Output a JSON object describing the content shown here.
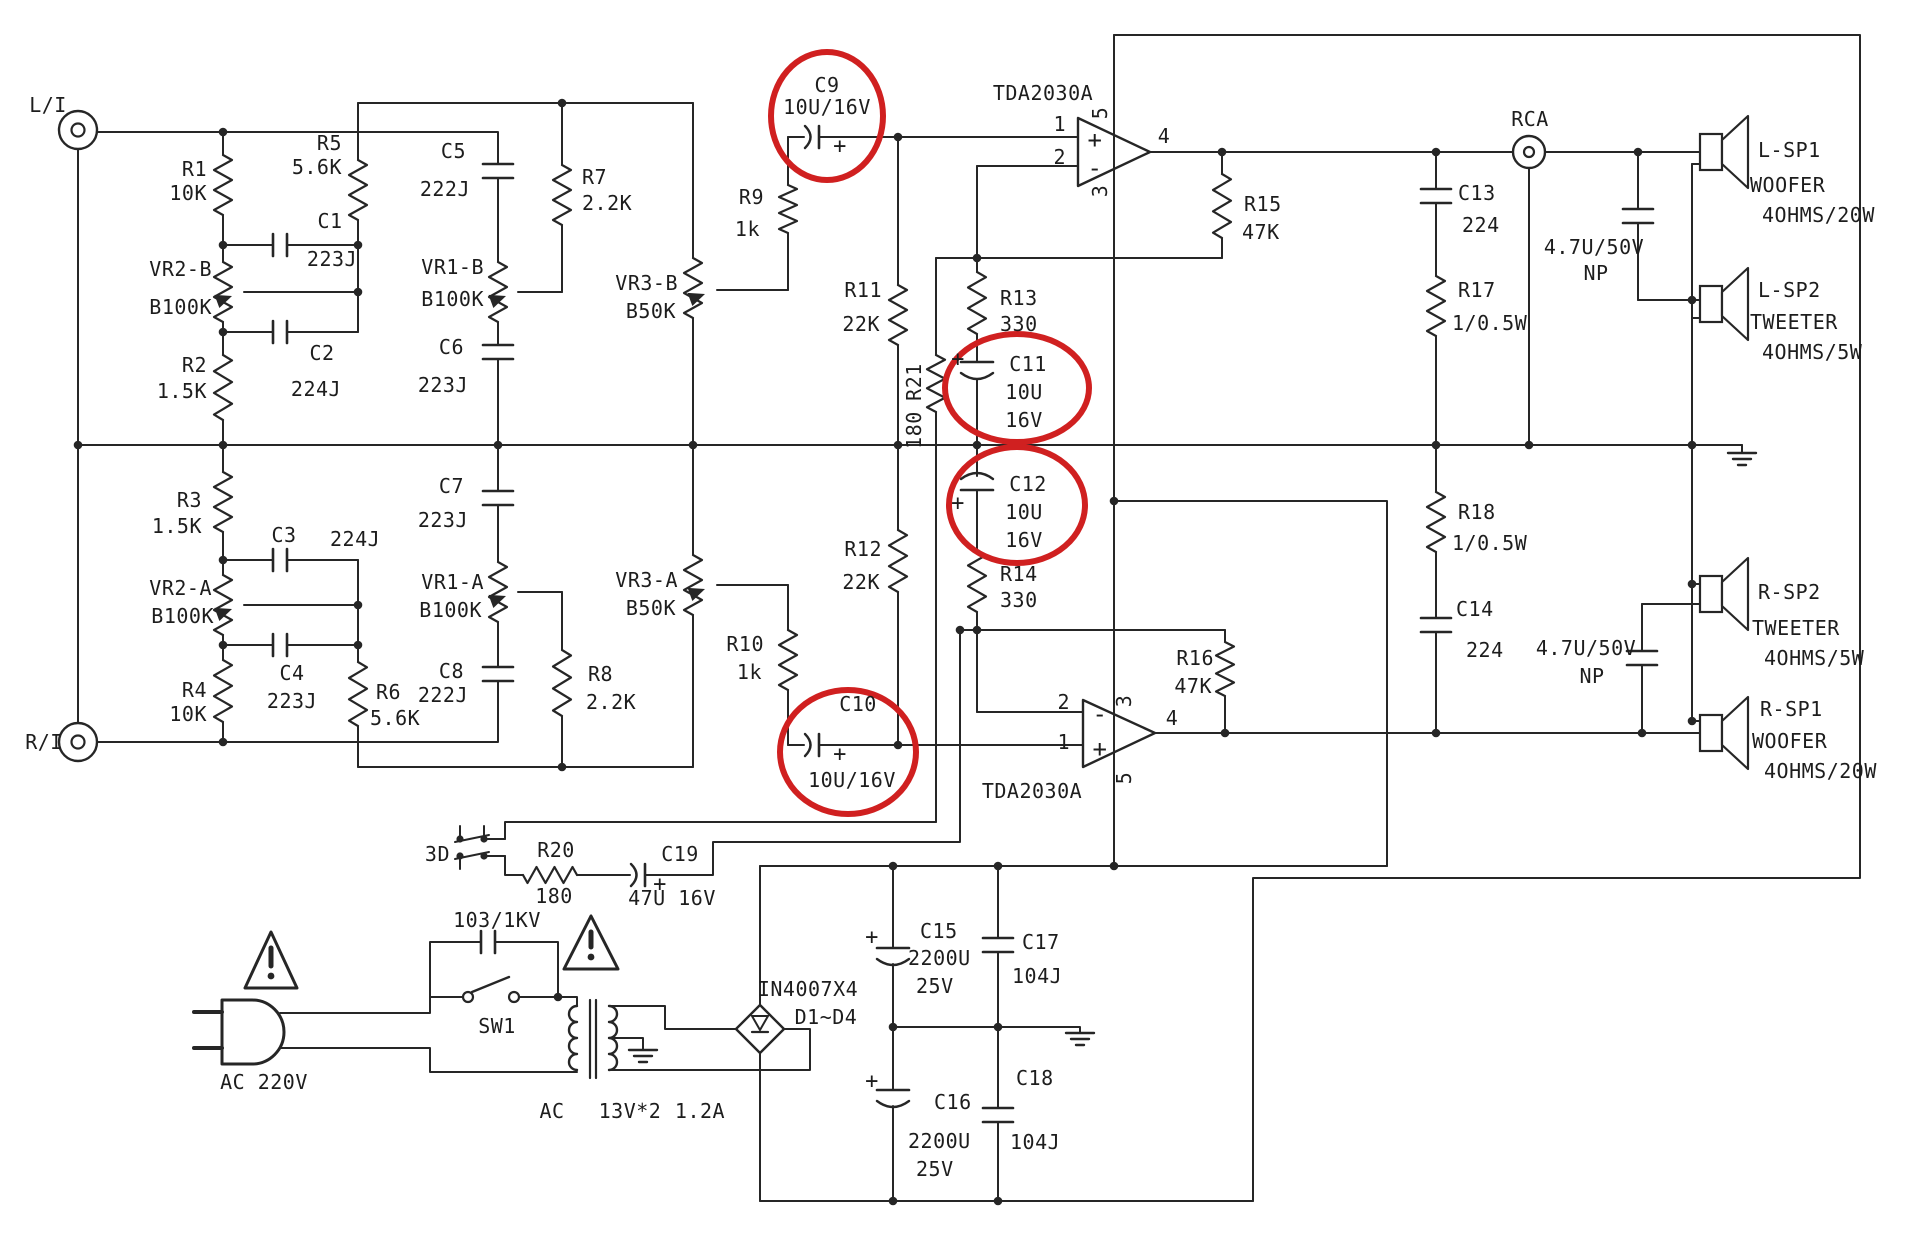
{
  "meta": {
    "description": "Scanned schematic of a TDA2030A stereo tone-control amplifier with power supply",
    "ink_color": "#262626",
    "highlight_color": "#d02020",
    "highlighted_parts": [
      "C9",
      "C10",
      "C11",
      "C12"
    ]
  },
  "labels": [
    {
      "id": "li",
      "t": "L/I",
      "x": 48,
      "y": 112,
      "a": "m"
    },
    {
      "id": "ri",
      "t": "R/I",
      "x": 44,
      "y": 749,
      "a": "m"
    },
    {
      "id": "r1",
      "t": "R1",
      "x": 207,
      "y": 176,
      "a": "e"
    },
    {
      "id": "r1v",
      "t": "10K",
      "x": 207,
      "y": 200,
      "a": "e"
    },
    {
      "id": "r5",
      "t": "R5",
      "x": 342,
      "y": 150,
      "a": "e"
    },
    {
      "id": "r5v",
      "t": "5.6K",
      "x": 342,
      "y": 174,
      "a": "e"
    },
    {
      "id": "c1",
      "t": "C1",
      "x": 330,
      "y": 228,
      "a": "m"
    },
    {
      "id": "c1v",
      "t": "223J",
      "x": 332,
      "y": 266,
      "a": "m"
    },
    {
      "id": "vr2b",
      "t": "VR2-B",
      "x": 212,
      "y": 276,
      "a": "e"
    },
    {
      "id": "vr2bv",
      "t": "B100K",
      "x": 212,
      "y": 314,
      "a": "e"
    },
    {
      "id": "c2",
      "t": "C2",
      "x": 322,
      "y": 360,
      "a": "m"
    },
    {
      "id": "c2v",
      "t": "224J",
      "x": 316,
      "y": 396,
      "a": "m"
    },
    {
      "id": "r2",
      "t": "R2",
      "x": 207,
      "y": 372,
      "a": "e"
    },
    {
      "id": "r2v",
      "t": "1.5K",
      "x": 207,
      "y": 398,
      "a": "e"
    },
    {
      "id": "c5",
      "t": "C5",
      "x": 466,
      "y": 158,
      "a": "e"
    },
    {
      "id": "c5v",
      "t": "222J",
      "x": 470,
      "y": 196,
      "a": "e"
    },
    {
      "id": "vr1b",
      "t": "VR1-B",
      "x": 484,
      "y": 274,
      "a": "e"
    },
    {
      "id": "vr1bv",
      "t": "B100K",
      "x": 484,
      "y": 306,
      "a": "e"
    },
    {
      "id": "c6",
      "t": "C6",
      "x": 464,
      "y": 354,
      "a": "e"
    },
    {
      "id": "c6v",
      "t": "223J",
      "x": 468,
      "y": 392,
      "a": "e"
    },
    {
      "id": "r7",
      "t": "R7",
      "x": 582,
      "y": 184,
      "a": "s"
    },
    {
      "id": "r7v",
      "t": "2.2K",
      "x": 582,
      "y": 210,
      "a": "s"
    },
    {
      "id": "vr3b",
      "t": "VR3-B",
      "x": 678,
      "y": 290,
      "a": "e"
    },
    {
      "id": "vr3bv",
      "t": "B50K",
      "x": 676,
      "y": 318,
      "a": "e"
    },
    {
      "id": "r9",
      "t": "R9",
      "x": 764,
      "y": 204,
      "a": "e"
    },
    {
      "id": "r9v",
      "t": "1k",
      "x": 760,
      "y": 236,
      "a": "e"
    },
    {
      "id": "c9",
      "t": "C9",
      "x": 827,
      "y": 92,
      "a": "m"
    },
    {
      "id": "c9v",
      "t": "10U/16V",
      "x": 827,
      "y": 114,
      "a": "m"
    },
    {
      "id": "c9p",
      "t": "+",
      "x": 840,
      "y": 153,
      "a": "m",
      "s": 22
    },
    {
      "id": "u1",
      "t": "TDA2030A",
      "x": 1043,
      "y": 100,
      "a": "m"
    },
    {
      "id": "u1p1",
      "t": "1",
      "x": 1066,
      "y": 131,
      "a": "e"
    },
    {
      "id": "u1p2",
      "t": "2",
      "x": 1066,
      "y": 164,
      "a": "e"
    },
    {
      "id": "u1plus",
      "t": "+",
      "x": 1095,
      "y": 148,
      "a": "m",
      "s": 24
    },
    {
      "id": "u1minus",
      "t": "-",
      "x": 1095,
      "y": 176,
      "a": "m",
      "s": 24
    },
    {
      "id": "u1p5",
      "t": "5",
      "x": 1107,
      "y": 113,
      "a": "m",
      "r": -90
    },
    {
      "id": "u1p3",
      "t": "3",
      "x": 1107,
      "y": 191,
      "a": "m",
      "r": -90
    },
    {
      "id": "u1p4",
      "t": "4",
      "x": 1164,
      "y": 143,
      "a": "m"
    },
    {
      "id": "r11",
      "t": "R11",
      "x": 882,
      "y": 297,
      "a": "e"
    },
    {
      "id": "r11v",
      "t": "22K",
      "x": 880,
      "y": 331,
      "a": "e"
    },
    {
      "id": "r21",
      "t": "R21",
      "x": 921,
      "y": 382,
      "a": "m",
      "r": -90
    },
    {
      "id": "r21v",
      "t": "180",
      "x": 921,
      "y": 430,
      "a": "m",
      "r": -90
    },
    {
      "id": "r13",
      "t": "R13",
      "x": 1000,
      "y": 305,
      "a": "s"
    },
    {
      "id": "r13v",
      "t": "330",
      "x": 1000,
      "y": 331,
      "a": "s"
    },
    {
      "id": "c11",
      "t": "C11",
      "x": 1028,
      "y": 371,
      "a": "m"
    },
    {
      "id": "c11v",
      "t": "10U",
      "x": 1024,
      "y": 399,
      "a": "m"
    },
    {
      "id": "c11v2",
      "t": "16V",
      "x": 1024,
      "y": 427,
      "a": "m"
    },
    {
      "id": "c11p",
      "t": "+",
      "x": 958,
      "y": 366,
      "a": "m",
      "s": 22
    },
    {
      "id": "c12",
      "t": "C12",
      "x": 1028,
      "y": 491,
      "a": "m"
    },
    {
      "id": "c12v",
      "t": "10U",
      "x": 1024,
      "y": 519,
      "a": "m"
    },
    {
      "id": "c12v2",
      "t": "16V",
      "x": 1024,
      "y": 547,
      "a": "m"
    },
    {
      "id": "c12p",
      "t": "+",
      "x": 958,
      "y": 510,
      "a": "m",
      "s": 22
    },
    {
      "id": "r14",
      "t": "R14",
      "x": 1000,
      "y": 581,
      "a": "s"
    },
    {
      "id": "r14v",
      "t": "330",
      "x": 1000,
      "y": 607,
      "a": "s"
    },
    {
      "id": "r12",
      "t": "R12",
      "x": 882,
      "y": 556,
      "a": "e"
    },
    {
      "id": "r12v",
      "t": "22K",
      "x": 880,
      "y": 589,
      "a": "e"
    },
    {
      "id": "r15",
      "t": "R15",
      "x": 1244,
      "y": 211,
      "a": "s"
    },
    {
      "id": "r15v",
      "t": "47K",
      "x": 1242,
      "y": 239,
      "a": "s"
    },
    {
      "id": "rca",
      "t": "RCA",
      "x": 1530,
      "y": 126,
      "a": "m"
    },
    {
      "id": "c13",
      "t": "C13",
      "x": 1458,
      "y": 200,
      "a": "s"
    },
    {
      "id": "c13v",
      "t": "224",
      "x": 1462,
      "y": 232,
      "a": "s"
    },
    {
      "id": "r17",
      "t": "R17",
      "x": 1458,
      "y": 297,
      "a": "s"
    },
    {
      "id": "r17v",
      "t": "1/0.5W",
      "x": 1452,
      "y": 330,
      "a": "s"
    },
    {
      "id": "np1",
      "t": "4.7U/50V",
      "x": 1594,
      "y": 254,
      "a": "m"
    },
    {
      "id": "np1v",
      "t": "NP",
      "x": 1596,
      "y": 280,
      "a": "m"
    },
    {
      "id": "lsp1",
      "t": "L-SP1",
      "x": 1758,
      "y": 157,
      "a": "s"
    },
    {
      "id": "lsp1t",
      "t": "WOOFER",
      "x": 1750,
      "y": 192,
      "a": "s"
    },
    {
      "id": "lsp1v",
      "t": "4OHMS/20W",
      "x": 1762,
      "y": 222,
      "a": "s"
    },
    {
      "id": "lsp2",
      "t": "L-SP2",
      "x": 1758,
      "y": 297,
      "a": "s"
    },
    {
      "id": "lsp2t",
      "t": "TWEETER",
      "x": 1750,
      "y": 329,
      "a": "s"
    },
    {
      "id": "lsp2v",
      "t": "4OHMS/5W",
      "x": 1762,
      "y": 359,
      "a": "s"
    },
    {
      "id": "r18",
      "t": "R18",
      "x": 1458,
      "y": 519,
      "a": "s"
    },
    {
      "id": "r18v",
      "t": "1/0.5W",
      "x": 1452,
      "y": 550,
      "a": "s"
    },
    {
      "id": "c14",
      "t": "C14",
      "x": 1456,
      "y": 616,
      "a": "s"
    },
    {
      "id": "c14v",
      "t": "224",
      "x": 1466,
      "y": 657,
      "a": "s"
    },
    {
      "id": "np2",
      "t": "4.7U/50V",
      "x": 1586,
      "y": 655,
      "a": "m"
    },
    {
      "id": "np2v",
      "t": "NP",
      "x": 1592,
      "y": 683,
      "a": "m"
    },
    {
      "id": "rsp2",
      "t": "R-SP2",
      "x": 1758,
      "y": 599,
      "a": "s"
    },
    {
      "id": "rsp2t",
      "t": "TWEETER",
      "x": 1752,
      "y": 635,
      "a": "s"
    },
    {
      "id": "rsp2v",
      "t": "4OHMS/5W",
      "x": 1764,
      "y": 665,
      "a": "s"
    },
    {
      "id": "rsp1",
      "t": "R-SP1",
      "x": 1760,
      "y": 716,
      "a": "s"
    },
    {
      "id": "rsp1t",
      "t": "WOOFER",
      "x": 1752,
      "y": 748,
      "a": "s"
    },
    {
      "id": "rsp1v",
      "t": "4OHMS/20W",
      "x": 1764,
      "y": 778,
      "a": "s"
    },
    {
      "id": "r3",
      "t": "R3",
      "x": 202,
      "y": 507,
      "a": "e"
    },
    {
      "id": "r3v",
      "t": "1.5K",
      "x": 202,
      "y": 533,
      "a": "e"
    },
    {
      "id": "c3",
      "t": "C3",
      "x": 284,
      "y": 542,
      "a": "m"
    },
    {
      "id": "c3v",
      "t": "224J",
      "x": 330,
      "y": 546,
      "a": "s"
    },
    {
      "id": "vr2a",
      "t": "VR2-A",
      "x": 212,
      "y": 595,
      "a": "e"
    },
    {
      "id": "vr2av",
      "t": "B100K",
      "x": 214,
      "y": 623,
      "a": "e"
    },
    {
      "id": "c4",
      "t": "C4",
      "x": 292,
      "y": 680,
      "a": "m"
    },
    {
      "id": "c4v",
      "t": "223J",
      "x": 292,
      "y": 708,
      "a": "m"
    },
    {
      "id": "r4",
      "t": "R4",
      "x": 207,
      "y": 697,
      "a": "e"
    },
    {
      "id": "r4v",
      "t": "10K",
      "x": 207,
      "y": 721,
      "a": "e"
    },
    {
      "id": "r6",
      "t": "R6",
      "x": 376,
      "y": 699,
      "a": "s"
    },
    {
      "id": "r6v",
      "t": "5.6K",
      "x": 370,
      "y": 725,
      "a": "s"
    },
    {
      "id": "c7",
      "t": "C7",
      "x": 464,
      "y": 493,
      "a": "e"
    },
    {
      "id": "c7v",
      "t": "223J",
      "x": 468,
      "y": 527,
      "a": "e"
    },
    {
      "id": "vr1a",
      "t": "VR1-A",
      "x": 484,
      "y": 589,
      "a": "e"
    },
    {
      "id": "vr1av",
      "t": "B100K",
      "x": 482,
      "y": 617,
      "a": "e"
    },
    {
      "id": "c8",
      "t": "C8",
      "x": 464,
      "y": 678,
      "a": "e"
    },
    {
      "id": "c8v",
      "t": "222J",
      "x": 468,
      "y": 702,
      "a": "e"
    },
    {
      "id": "r8",
      "t": "R8",
      "x": 588,
      "y": 681,
      "a": "s"
    },
    {
      "id": "r8v",
      "t": "2.2K",
      "x": 586,
      "y": 709,
      "a": "s"
    },
    {
      "id": "vr3a",
      "t": "VR3-A",
      "x": 678,
      "y": 587,
      "a": "e"
    },
    {
      "id": "vr3av",
      "t": "B50K",
      "x": 676,
      "y": 615,
      "a": "e"
    },
    {
      "id": "r10",
      "t": "R10",
      "x": 764,
      "y": 651,
      "a": "e"
    },
    {
      "id": "r10v",
      "t": "1k",
      "x": 762,
      "y": 679,
      "a": "e"
    },
    {
      "id": "c10",
      "t": "C10",
      "x": 858,
      "y": 711,
      "a": "m"
    },
    {
      "id": "c10v",
      "t": "10U/16V",
      "x": 852,
      "y": 787,
      "a": "m"
    },
    {
      "id": "c10p",
      "t": "+",
      "x": 840,
      "y": 761,
      "a": "m",
      "s": 22
    },
    {
      "id": "u2",
      "t": "TDA2030A",
      "x": 1032,
      "y": 798,
      "a": "m"
    },
    {
      "id": "u2p2",
      "t": "2",
      "x": 1070,
      "y": 709,
      "a": "e"
    },
    {
      "id": "u2p1",
      "t": "1",
      "x": 1070,
      "y": 749,
      "a": "e"
    },
    {
      "id": "u2minus",
      "t": "-",
      "x": 1100,
      "y": 722,
      "a": "m",
      "s": 24
    },
    {
      "id": "u2plus",
      "t": "+",
      "x": 1100,
      "y": 757,
      "a": "m",
      "s": 24
    },
    {
      "id": "u2p3",
      "t": "3",
      "x": 1131,
      "y": 701,
      "a": "m",
      "r": -90
    },
    {
      "id": "u2p5",
      "t": "5",
      "x": 1131,
      "y": 778,
      "a": "m",
      "r": -90
    },
    {
      "id": "u2p4",
      "t": "4",
      "x": 1172,
      "y": 725,
      "a": "m"
    },
    {
      "id": "r16",
      "t": "R16",
      "x": 1214,
      "y": 665,
      "a": "e"
    },
    {
      "id": "r16v",
      "t": "47K",
      "x": 1212,
      "y": 693,
      "a": "e"
    },
    {
      "id": "sw3d",
      "t": "3D",
      "x": 450,
      "y": 861,
      "a": "e"
    },
    {
      "id": "r20",
      "t": "R20",
      "x": 556,
      "y": 857,
      "a": "m"
    },
    {
      "id": "r20v",
      "t": "180",
      "x": 554,
      "y": 903,
      "a": "m"
    },
    {
      "id": "c19",
      "t": "C19",
      "x": 680,
      "y": 861,
      "a": "m"
    },
    {
      "id": "c19v",
      "t": "47U 16V",
      "x": 672,
      "y": 905,
      "a": "m"
    },
    {
      "id": "c19p",
      "t": "+",
      "x": 660,
      "y": 891,
      "a": "m",
      "s": 22
    },
    {
      "id": "cx",
      "t": "103/1KV",
      "x": 497,
      "y": 927,
      "a": "m"
    },
    {
      "id": "sw1",
      "t": "SW1",
      "x": 497,
      "y": 1033,
      "a": "m"
    },
    {
      "id": "ac",
      "t": "AC 220V",
      "x": 264,
      "y": 1089,
      "a": "m"
    },
    {
      "id": "acs1",
      "t": "AC",
      "x": 552,
      "y": 1118,
      "a": "m"
    },
    {
      "id": "acs2",
      "t": "13V*2",
      "x": 630,
      "y": 1118,
      "a": "m"
    },
    {
      "id": "acs3",
      "t": "1.2A",
      "x": 700,
      "y": 1118,
      "a": "m"
    },
    {
      "id": "br",
      "t": "IN4007X4",
      "x": 808,
      "y": 996,
      "a": "m"
    },
    {
      "id": "brv",
      "t": "D1~D4",
      "x": 826,
      "y": 1024,
      "a": "m"
    },
    {
      "id": "c15",
      "t": "C15",
      "x": 920,
      "y": 938,
      "a": "s"
    },
    {
      "id": "c15v",
      "t": "2200U",
      "x": 908,
      "y": 965,
      "a": "s"
    },
    {
      "id": "c15v2",
      "t": "25V",
      "x": 916,
      "y": 993,
      "a": "s"
    },
    {
      "id": "c15p",
      "t": "+",
      "x": 872,
      "y": 944,
      "a": "m",
      "s": 22
    },
    {
      "id": "c17",
      "t": "C17",
      "x": 1022,
      "y": 949,
      "a": "s"
    },
    {
      "id": "c17v",
      "t": "104J",
      "x": 1012,
      "y": 983,
      "a": "s"
    },
    {
      "id": "c16",
      "t": "C16",
      "x": 934,
      "y": 1109,
      "a": "s"
    },
    {
      "id": "c16v",
      "t": "2200U",
      "x": 908,
      "y": 1148,
      "a": "s"
    },
    {
      "id": "c16v2",
      "t": "25V",
      "x": 916,
      "y": 1176,
      "a": "s"
    },
    {
      "id": "c16p",
      "t": "+",
      "x": 872,
      "y": 1088,
      "a": "m",
      "s": 22
    },
    {
      "id": "c18",
      "t": "C18",
      "x": 1016,
      "y": 1085,
      "a": "s"
    },
    {
      "id": "c18v",
      "t": "104J",
      "x": 1010,
      "y": 1149,
      "a": "s"
    }
  ]
}
